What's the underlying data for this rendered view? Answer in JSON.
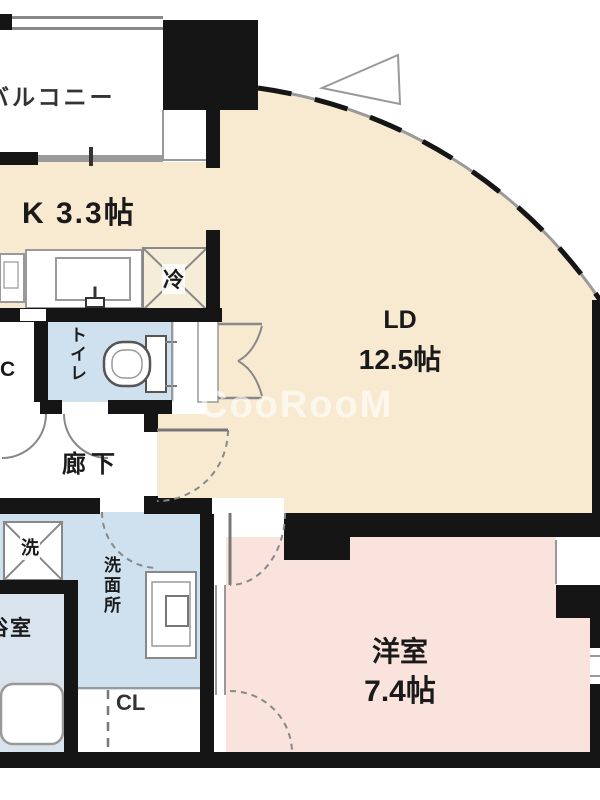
{
  "floorplan": {
    "watermark": "CooRooM",
    "rooms": {
      "balcony": {
        "label": "バルコニー"
      },
      "kitchen": {
        "label": "K 3.3帖"
      },
      "living_dining": {
        "name": "LD",
        "size": "12.5帖"
      },
      "western_room": {
        "name": "洋室",
        "size": "7.4帖"
      },
      "toilet": {
        "label": "トイレ"
      },
      "hallway": {
        "label": "廊下"
      },
      "washroom": {
        "label": "洗面所"
      },
      "bathroom": {
        "label": "浴室"
      },
      "closet": {
        "label": "CL"
      },
      "partial_left_label": {
        "label": "C"
      }
    },
    "fixtures": {
      "refrigerator": {
        "label": "冷"
      },
      "washing_machine": {
        "label": "洗"
      }
    },
    "colors": {
      "room_cream": "#f8ead0",
      "room_pink": "#f9e3dc",
      "room_blue": "#cfe0ee",
      "room_bath_blue": "#d8e3ed",
      "wall_black": "#151515",
      "line_gray": "#999999",
      "watermark_white": "rgba(255,255,255,0.6)"
    }
  }
}
